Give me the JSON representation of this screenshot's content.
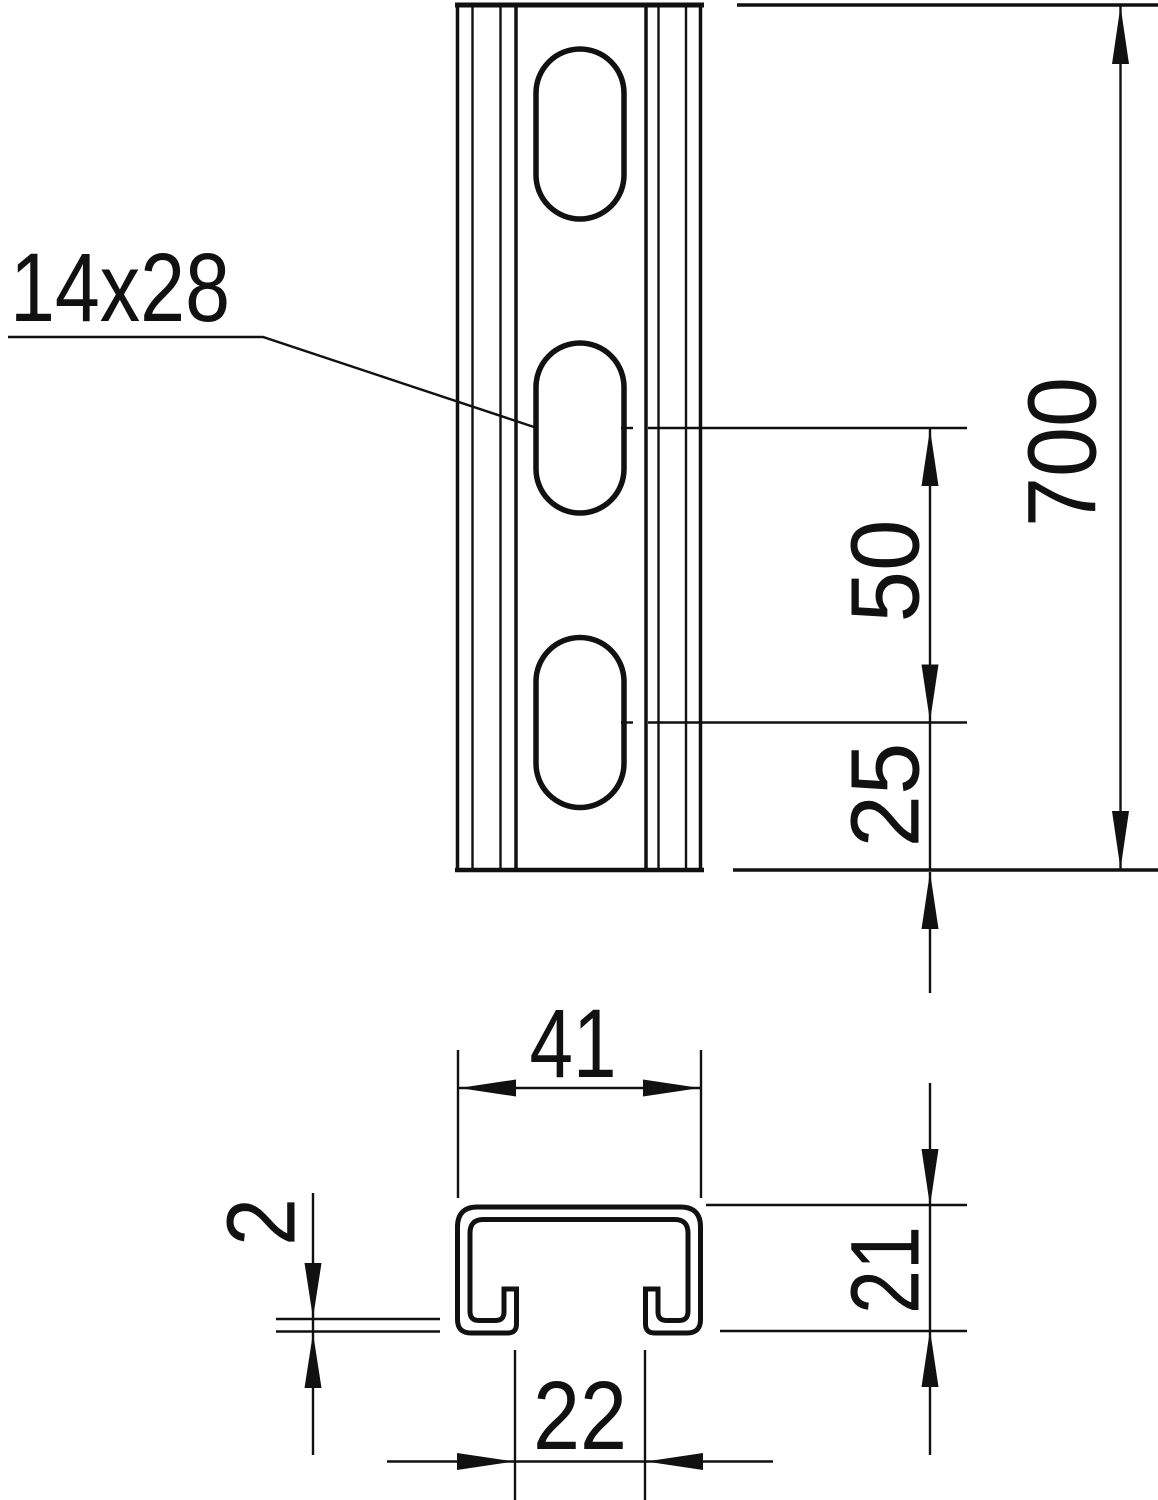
{
  "drawing_title": "slotted-strut-channel-dimension-drawing",
  "front_view": {
    "slot_size_label": "14x28",
    "dim_total_length": "700",
    "dim_slot_spacing": "50",
    "dim_end_distance": "25"
  },
  "section_view": {
    "dim_outer_width": "41",
    "dim_profile_height": "21",
    "dim_opening_width": "22",
    "dim_material_thickness": "2"
  },
  "colors": {
    "line": "#111111",
    "background": "#ffffff"
  }
}
